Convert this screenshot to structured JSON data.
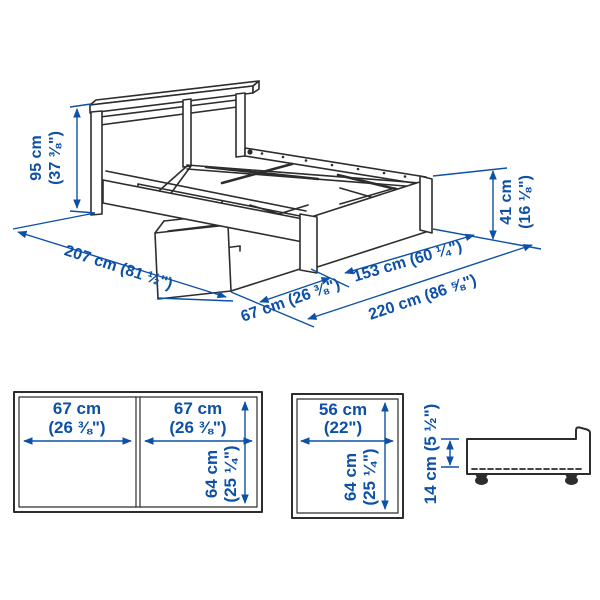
{
  "colors": {
    "dimension_blue": "#0d51a6",
    "line_dark": "#2d2d2d",
    "background": "#ffffff"
  },
  "main_diagram": {
    "headboard_height": {
      "l1": "95 cm",
      "l2": "(37 ⅜\")"
    },
    "bed_length": "207 cm (81 ½\")",
    "storage_box_depth": "67 cm (26 ⅜\")",
    "bed_width": "153 cm (60 ¼\")",
    "total_width_with_box": "220 cm (86 ⅝\")",
    "footboard_height": {
      "l1": "41 cm",
      "l2": "(16 ⅛\")"
    }
  },
  "double_storage_box_top_view": {
    "left_width": {
      "l1": "67 cm",
      "l2": "(26 ⅜\")"
    },
    "right_width": {
      "l1": "67 cm",
      "l2": "(26 ⅜\")"
    },
    "depth": {
      "l1": "64 cm",
      "l2": "(25 ¼\")"
    }
  },
  "single_storage_box_top_view": {
    "width": {
      "l1": "56 cm",
      "l2": "(22\")"
    },
    "depth": {
      "l1": "64 cm",
      "l2": "(25 ¼\")"
    }
  },
  "storage_box_side_view": {
    "height": "14 cm (5 ½\")"
  }
}
